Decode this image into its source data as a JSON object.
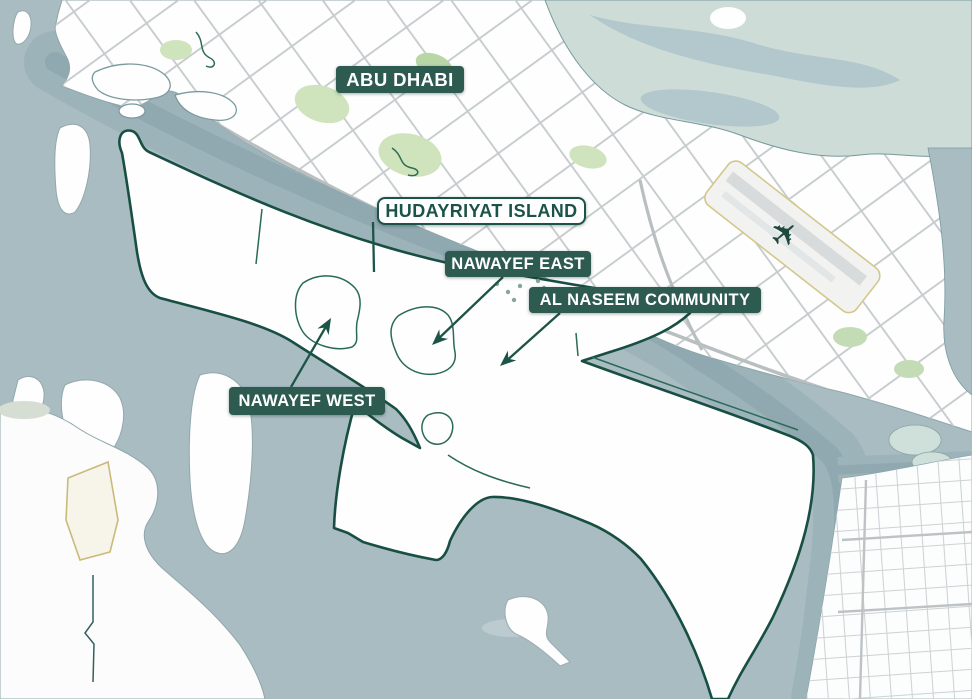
{
  "page": {
    "type": "map",
    "subject": "Overview map of Hudayriyat Island and Abu Dhabi with community callouts"
  },
  "labels": {
    "city": {
      "text": "ABU DHABI",
      "style": "filled"
    },
    "island": {
      "text": "HUDAYRIYAT ISLAND",
      "style": "outlined"
    },
    "nawayef_east": {
      "text": "NAWAYEF EAST",
      "style": "filled"
    },
    "al_naseem": {
      "text": "AL NASEEM COMMUNITY",
      "style": "filled"
    },
    "nawayef_west": {
      "text": "NAWAYEF WEST",
      "style": "filled"
    }
  },
  "icons": {
    "airplane_glyph": "✈"
  },
  "colors": {
    "water": "#a8bcc2",
    "channel": "#9db3ba",
    "channel_core": "#90a8b0",
    "land": "#fdfefd",
    "island_outline": "#184f42",
    "label_bg": "#2d5b50",
    "label_text": "#ffffff",
    "outlined_label_text": "#1c5348",
    "street_gray": "#c6cbcd",
    "park_green": "#cfe3bc",
    "mangrove": "#cddcd6",
    "runway_yellow": "#d3c78c"
  }
}
